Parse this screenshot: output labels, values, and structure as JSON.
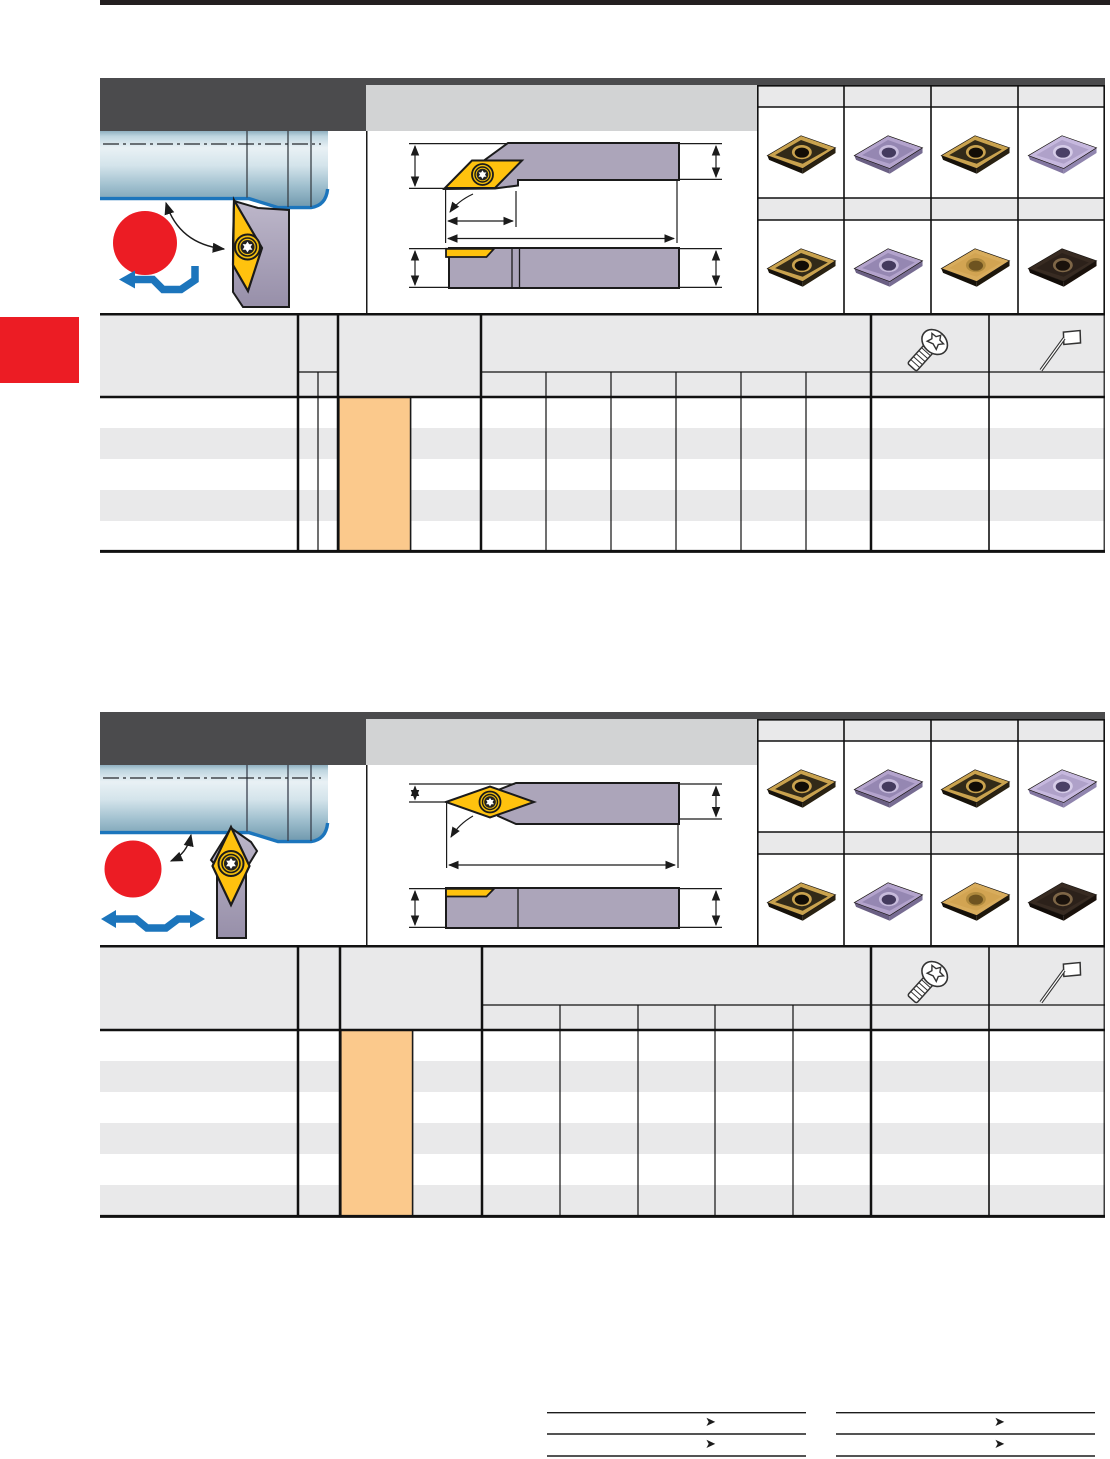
{
  "page": {
    "kind": "tooling-catalog-page",
    "title": "",
    "side_tab": {
      "color": "#EC1C24",
      "label": ""
    },
    "footer": {
      "arrow_glyph": "➤",
      "left_table": {
        "rows": 2,
        "row_labels": [
          "",
          ""
        ]
      },
      "right_table": {
        "rows": 2,
        "row_labels": [
          "",
          ""
        ]
      }
    },
    "colors": {
      "rule_black": "#231F20",
      "band_dark": "#4B4B4D",
      "band_gray": "#D2D3D4",
      "cell_gray": "#E9E9EA",
      "highlight_orange": "#FBC98C",
      "marker_red": "#EC1C24",
      "feed_arrow_blue": "#1C75BC",
      "insert_yellow": "#FFC20E",
      "holder_gray": "#ACA5BA",
      "workpiece_blue_edge": "#1C75BC"
    }
  },
  "insert_variants": {
    "gold-black": {
      "face": "#C9A24E",
      "inner": "#322A18",
      "edge": "#17120A",
      "edge2": "#2A2212",
      "rim": "#C9A24E",
      "hole": "#120D06"
    },
    "purple": {
      "face": "#B3A3CC",
      "inner": "#9587B2",
      "edge": "#6A5F83",
      "edge2": "#776C92",
      "rim": "#C7BBDC",
      "hole": "#443A5E"
    },
    "purple-light": {
      "face": "#C6B8DE",
      "inner": "#AFA1C9",
      "edge": "#8276A0",
      "edge2": "#9085AE",
      "rim": "#D6CCE8",
      "hole": "#4A4066"
    },
    "gold": {
      "face": "#D8AC5C",
      "inner": "#D2A452",
      "edge": "#151008",
      "edge2": "#1E170B",
      "rim": "#B08A3E",
      "hole": "#6E5320"
    },
    "dark-brown": {
      "face": "#382B22",
      "inner": "#2C211A",
      "edge": "#120C08",
      "edge2": "#1A110B",
      "rim": "#7E6647",
      "hole": "#1A120C"
    }
  },
  "sections": [
    {
      "band_title": "",
      "application": {
        "marker": "red-circle",
        "feed_arrow": "zigzag-left",
        "workpiece": "stepped-cylinder",
        "tool": "screw-clamp-v-holder-angled"
      },
      "drawing_labels": {
        "side_view": "",
        "top_view": "",
        "dims": [
          "",
          "",
          "",
          "",
          ""
        ]
      },
      "insert_grid": {
        "columns": 4,
        "row_labels": [
          "",
          ""
        ],
        "rows": [
          [
            "gold-black",
            "purple",
            "gold-black",
            "purple-light"
          ],
          [
            "gold-black",
            "purple",
            "gold",
            "dark-brown"
          ]
        ]
      },
      "table": {
        "designation_header": "",
        "narrow_columns": 2,
        "dimension_columns": 6,
        "body_rows": 5,
        "header_icons": [
          "torx-screw-icon",
          "torx-key-icon"
        ],
        "highlight_column": {
          "color": "#FBC98C",
          "values": [
            "",
            "",
            "",
            "",
            ""
          ]
        },
        "cells_text": ""
      }
    },
    {
      "band_title": "",
      "application": {
        "marker": "red-circle",
        "feed_arrow": "zigzag-both",
        "workpiece": "stepped-cylinder",
        "tool": "screw-clamp-v-holder-neutral"
      },
      "drawing_labels": {
        "side_view": "",
        "top_view": "",
        "dims": [
          "",
          "",
          "",
          ""
        ]
      },
      "insert_grid": {
        "columns": 4,
        "row_labels": [
          "",
          ""
        ],
        "rows": [
          [
            "gold-black",
            "purple",
            "gold-black",
            "purple-light"
          ],
          [
            "gold-black",
            "purple",
            "gold",
            "dark-brown"
          ]
        ]
      },
      "table": {
        "designation_header": "",
        "narrow_columns": 1,
        "dimension_columns": 5,
        "body_rows": 6,
        "header_icons": [
          "torx-screw-icon",
          "torx-key-icon"
        ],
        "highlight_column": {
          "color": "#FBC98C",
          "values": [
            "",
            "",
            "",
            "",
            "",
            ""
          ]
        },
        "cells_text": ""
      }
    }
  ]
}
